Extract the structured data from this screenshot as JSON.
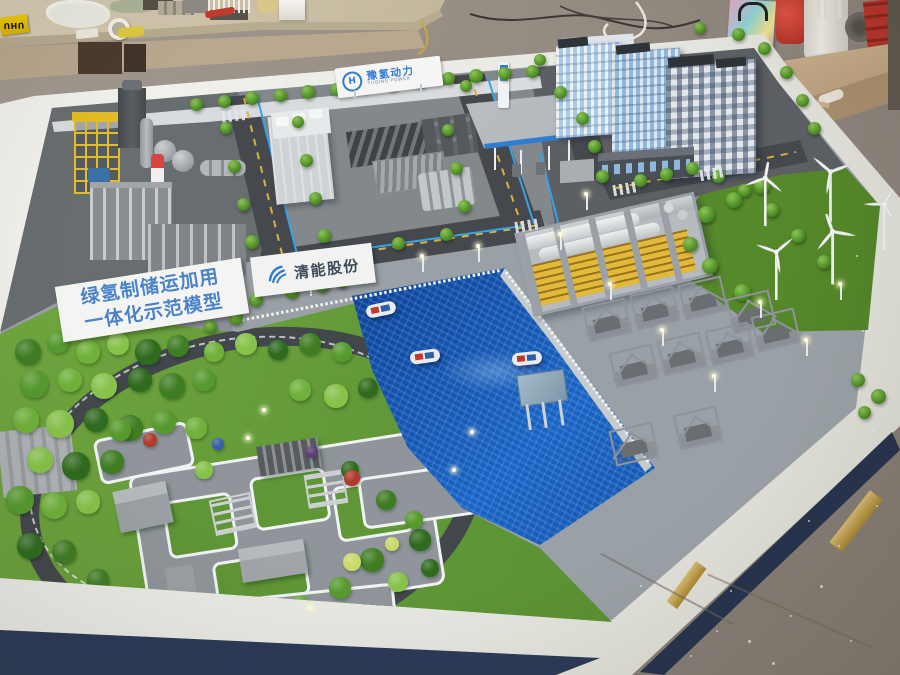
{
  "meta": {
    "type": "photograph",
    "subject": "Architectural scale model of a green hydrogen industrial park displayed on a white table in a model-maker workshop"
  },
  "signs": {
    "banner": {
      "line1": "绿氢制储运加用",
      "line2": "一体化示范模型"
    },
    "company_sign": {
      "text": "清能股份"
    },
    "gate_sign": {
      "cn": "豫氢动力",
      "en": "YUQING POWER",
      "logo_letter": "H"
    },
    "glue_box": {
      "text": "UHU"
    }
  },
  "scene_elements": [
    "industrial-plant",
    "red-white-chimney",
    "spherical-tanks",
    "yellow-gantry-tower",
    "electrolyzer-warehouse",
    "hydrogen-refueling-station",
    "office-towers",
    "wind-turbines",
    "canal-with-boats",
    "tube-storage-warehouse",
    "compressor-skids",
    "pier-platform",
    "landscaped-garden",
    "ring-road",
    "garden-plaza",
    "street-trees",
    "workbench-clutter",
    "gift-bag",
    "red-power-tool",
    "display-table"
  ],
  "colors": {
    "water": "#0c3f92",
    "lawn": "#69a03c",
    "road": "#45494e",
    "table": "#f2f2ec",
    "table_skirt": "#2b3a58",
    "floor": "#98918a",
    "accent_blue": "#2f7cd0",
    "safety_yellow": "#e3bd25",
    "chimney_red": "#d64541"
  }
}
